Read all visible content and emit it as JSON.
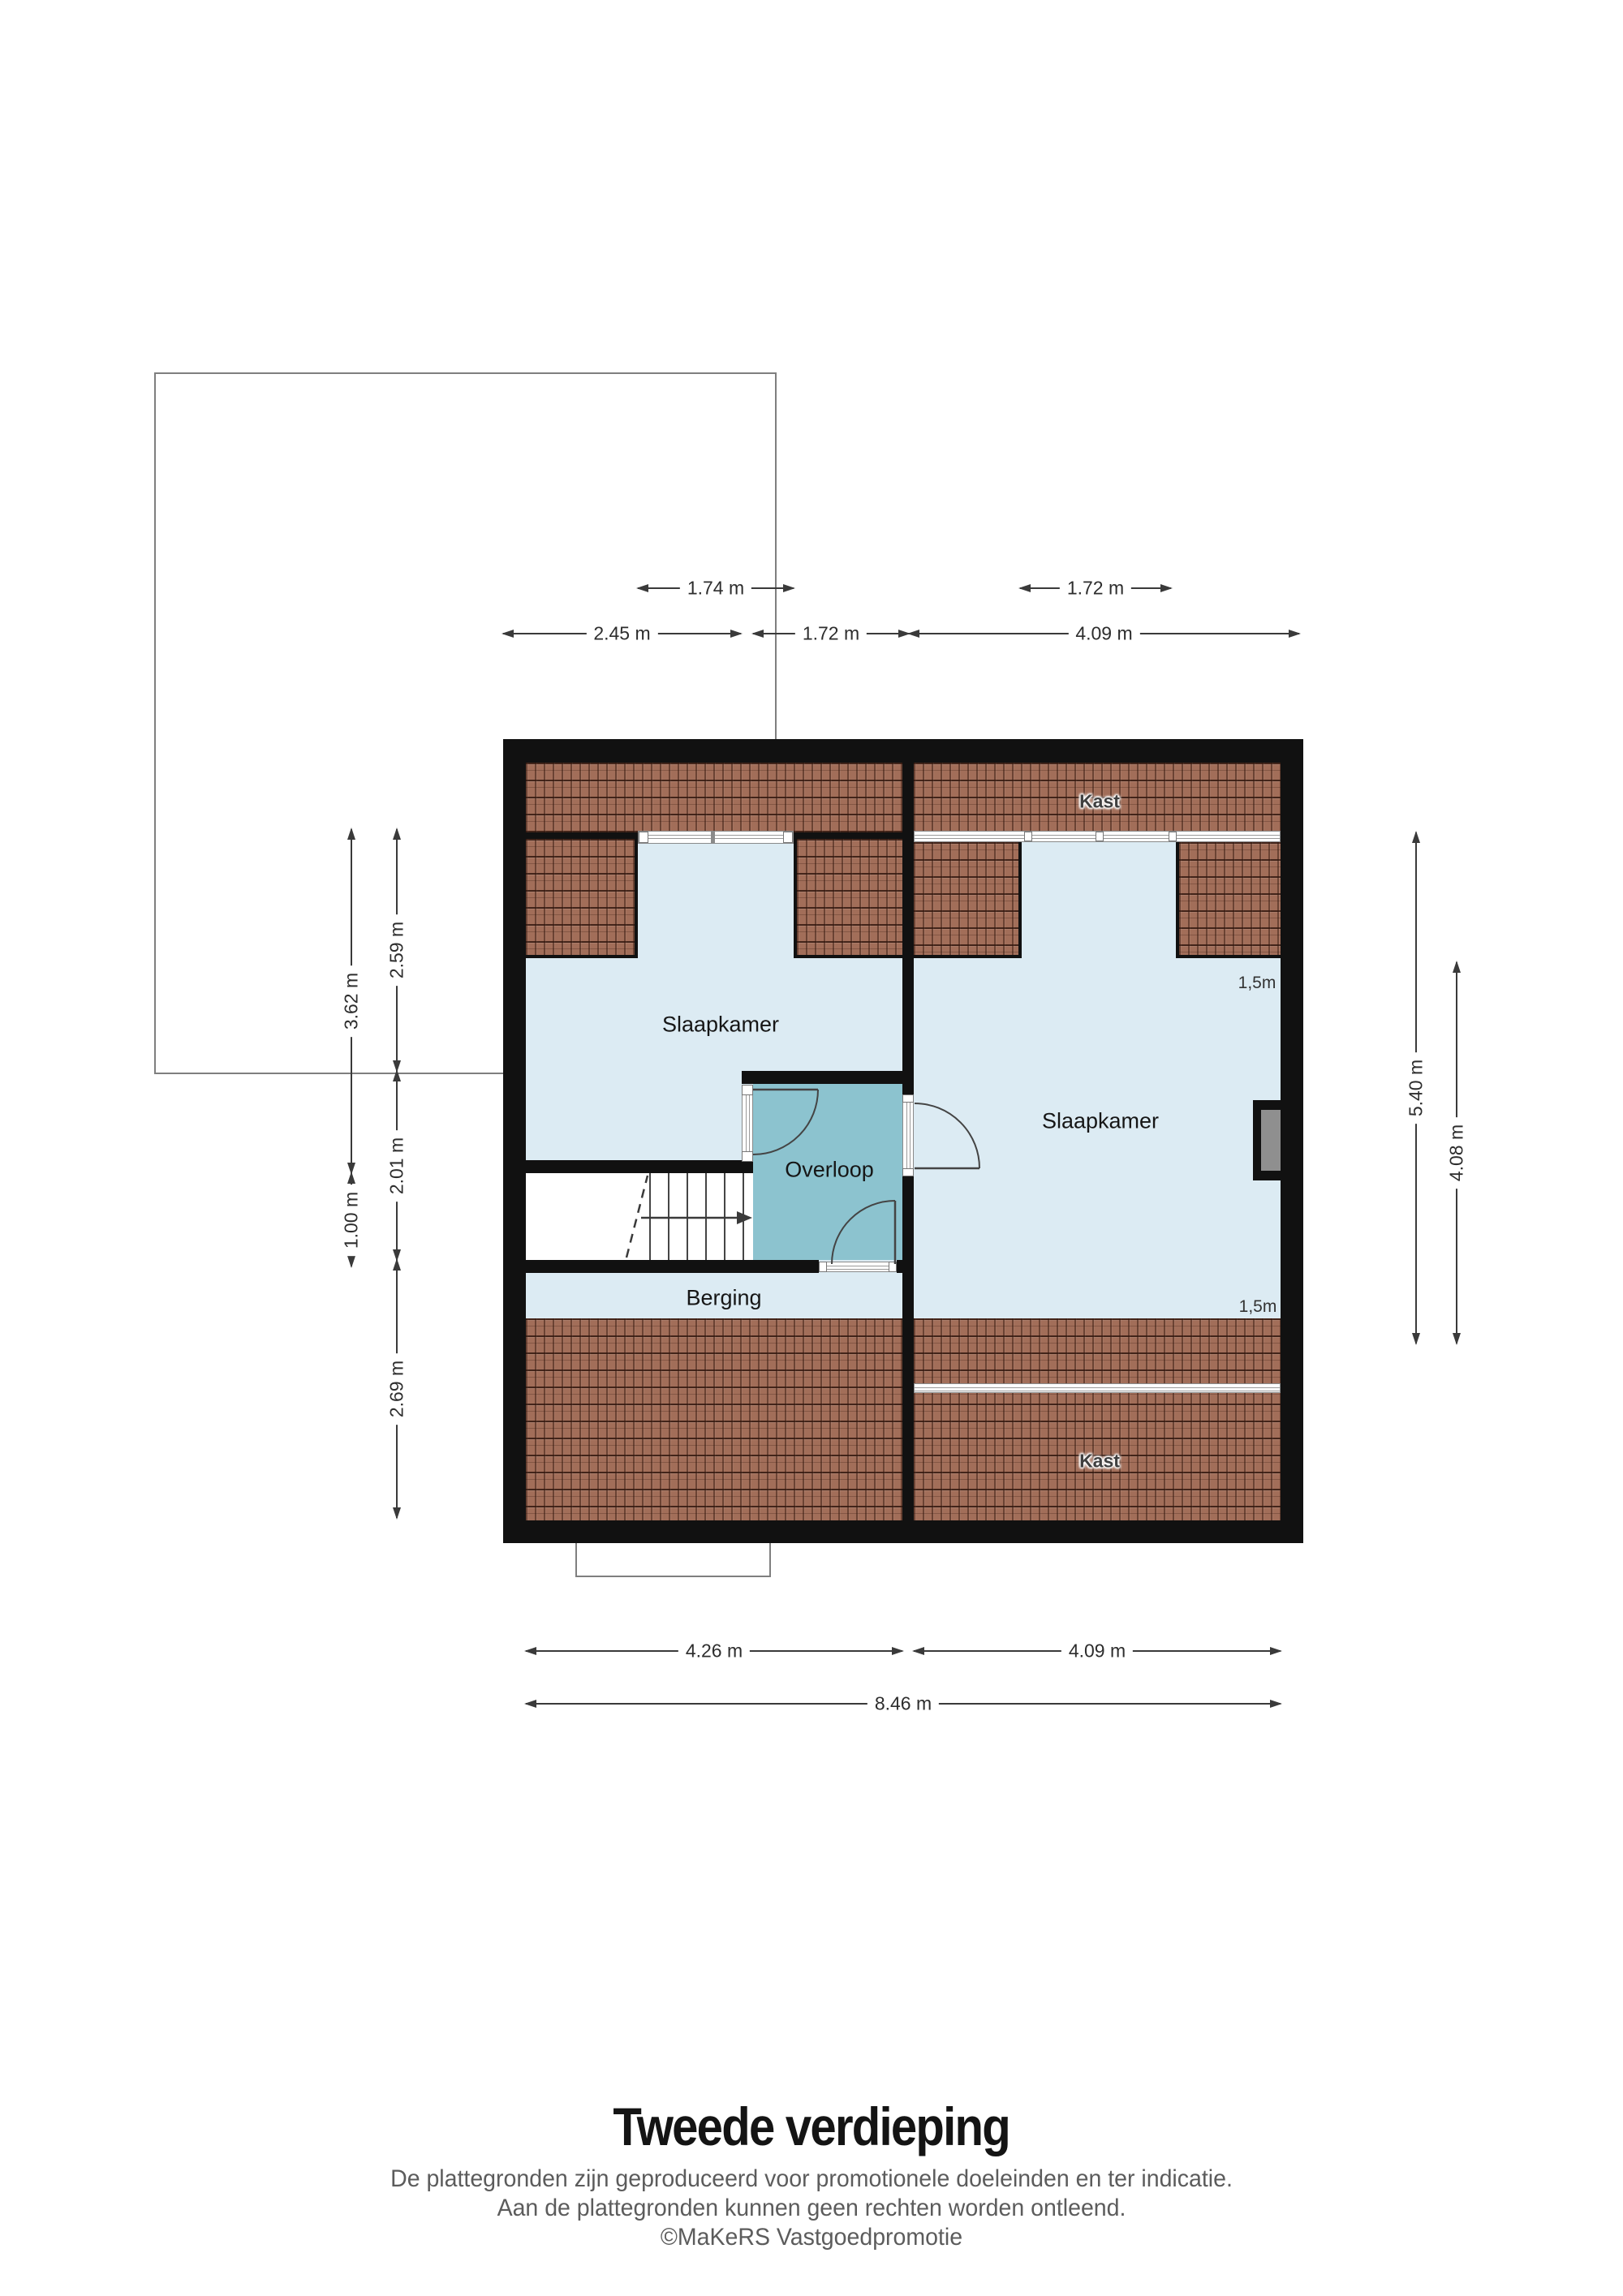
{
  "plan": {
    "floor_title": "Tweede verdieping",
    "rooms": {
      "bedroom_left": {
        "label": "Slaapkamer"
      },
      "bedroom_right": {
        "label": "Slaapkamer"
      },
      "landing": {
        "label": "Overloop"
      },
      "storage": {
        "label": "Berging"
      },
      "closet_top": {
        "label": "Kast"
      },
      "closet_bottom": {
        "label": "Kast"
      },
      "headroom_top": {
        "label": "1,5m"
      },
      "headroom_bottom": {
        "label": "1,5m"
      }
    },
    "dimensions": {
      "top_dormer_left": {
        "label": "1.74 m"
      },
      "top_dormer_right": {
        "label": "1.72 m"
      },
      "top_left": {
        "label": "2.45 m"
      },
      "top_mid": {
        "label": "1.72 m"
      },
      "top_right": {
        "label": "4.09 m"
      },
      "left_outer_upper": {
        "label": "3.62 m"
      },
      "left_outer_lower": {
        "label": "1.00 m"
      },
      "left_inner_upper": {
        "label": "2.59 m"
      },
      "left_inner_mid": {
        "label": "2.01 m"
      },
      "left_inner_lower": {
        "label": "2.69 m"
      },
      "right_outer": {
        "label": "5.40 m"
      },
      "right_inner": {
        "label": "4.08 m"
      },
      "bottom_left": {
        "label": "4.26 m"
      },
      "bottom_right": {
        "label": "4.09 m"
      },
      "bottom_total": {
        "label": "8.46 m"
      }
    },
    "colors": {
      "wall": "#111111",
      "room_fill": "#dcebf3",
      "landing_fill": "#8cc3cf",
      "roof_fill": "#a26e59",
      "outline": "#7f7f7f",
      "dimension": "#3a3a3a"
    }
  },
  "footer": {
    "line1": "De plattegronden zijn geproduceerd voor promotionele doeleinden en ter indicatie.",
    "line2": "Aan de plattegronden kunnen geen rechten worden ontleend.",
    "line3": "©MaKeRS Vastgoedpromotie"
  }
}
